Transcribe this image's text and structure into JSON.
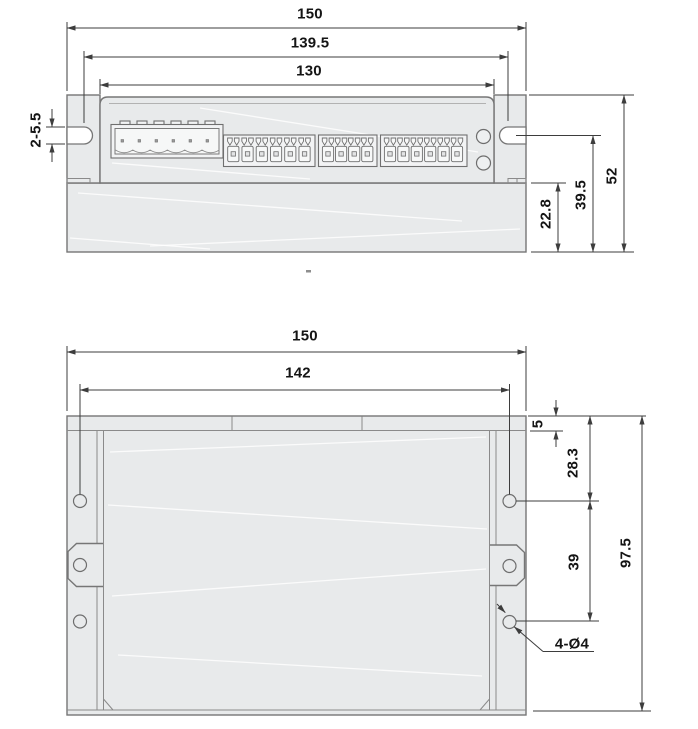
{
  "drawing_title": "stepper-driver-outline-dimension-drawing",
  "colors": {
    "body": "#e8eaeb",
    "outline": "#767676",
    "dimension": "#3d3d3d",
    "text": "#141414"
  },
  "front_view": {
    "labels": {
      "overall_width": "150",
      "slot_center_span": "139.5",
      "body_width": "130",
      "slot_spec": "2-5.5",
      "overall_height": "52",
      "slot_center_height": "39.5",
      "base_height": "22.8"
    }
  },
  "top_view": {
    "labels": {
      "overall_width": "150",
      "hole_center_span": "142",
      "end_step": "5",
      "first_hole_offset": "28.3",
      "hole_pitch": "39",
      "overall_depth": "97.5",
      "hole_callout": "4-Ø4"
    }
  }
}
